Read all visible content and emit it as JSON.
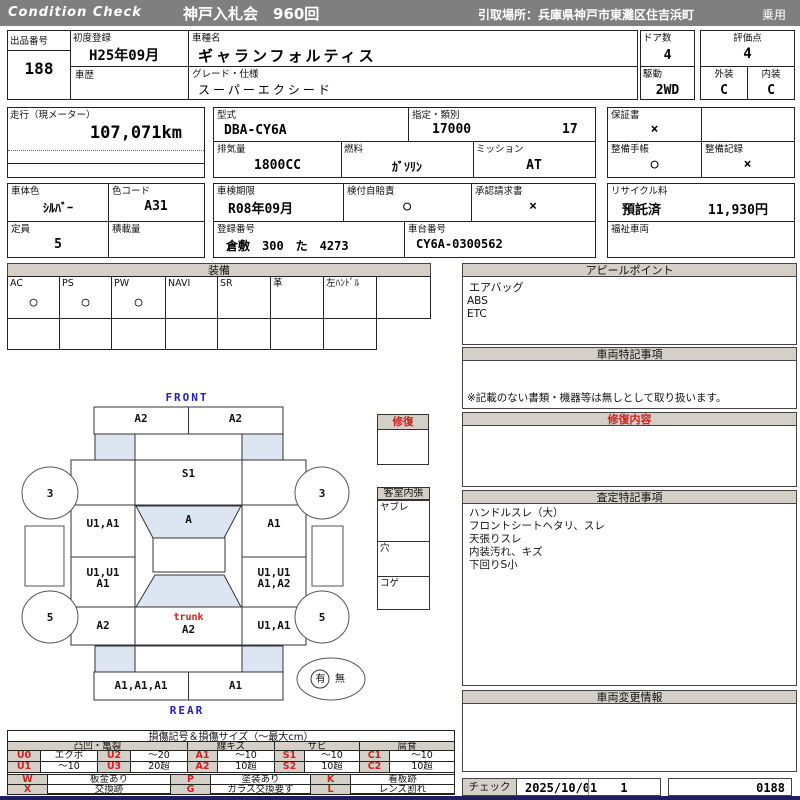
{
  "header": {
    "brand": "Condition  Check",
    "auction": "神戸入札会　960回",
    "pickup": "引取場所：兵庫県神戸市東灘区住吉浜町",
    "category": "乗用"
  },
  "info": {
    "exhibit_no_label": "出品番号",
    "exhibit_no": "188",
    "first_reg_label": "初度登録",
    "first_reg": "H25年09月",
    "history_label": "車歴",
    "model_name_label": "車種名",
    "model_name": "ギャランフォルティス",
    "grade_label": "グレード・仕様",
    "grade": "スーパーエクシード",
    "doors_label": "ドア数",
    "doors": "4",
    "drive_label": "駆動",
    "drive": "2WD",
    "score_label": "評価点",
    "score": "4",
    "exterior_label": "外装",
    "exterior": "C",
    "interior_label": "内装",
    "interior": "C",
    "mileage_label": "走行（現メーター）",
    "mileage": "107,071km",
    "model_code_label": "型式",
    "model_code": "DBA-CY6A",
    "class_label": "指定・類別",
    "class1": "17000",
    "class2": "17",
    "displacement_label": "排気量",
    "displacement": "1800CC",
    "fuel_label": "燃料",
    "fuel": "ｶﾞｿﾘﾝ",
    "mission_label": "ミッション",
    "mission": "AT",
    "warranty_label": "保証書",
    "warranty": "×",
    "maintenance_book_label": "整備手帳",
    "maintenance_book": "○",
    "maintenance_record_label": "整備記録",
    "maintenance_record": "×",
    "body_color_label": "車体色",
    "body_color": "ｼﾙﾊﾞｰ",
    "color_code_label": "色コード",
    "color_code": "A31",
    "capacity_label": "定員",
    "capacity": "5",
    "load_label": "積載量",
    "inspection_label": "車検期限",
    "inspection": "R08年09月",
    "insurance_label": "検付自賠責",
    "insurance": "○",
    "approval_label": "承認請求書",
    "approval": "×",
    "reg_no_label": "登録番号",
    "reg_no": "倉敷　300　た　4273",
    "chassis_label": "車台番号",
    "chassis": "CY6A-0300562",
    "recycle_label": "リサイクル料",
    "recycle_status": "預託済",
    "recycle_fee": "11,930円",
    "welfare_label": "福祉車両"
  },
  "equipment": {
    "title": "装備",
    "items": [
      {
        "label": "AC",
        "value": "○"
      },
      {
        "label": "PS",
        "value": "○"
      },
      {
        "label": "PW",
        "value": "○"
      },
      {
        "label": "NAVI",
        "value": ""
      },
      {
        "label": "SR",
        "value": ""
      },
      {
        "label": "革",
        "value": ""
      },
      {
        "label": "左ﾊﾝﾄﾞﾙ",
        "value": ""
      }
    ]
  },
  "panels": {
    "appeal": {
      "title": "アピールポイント",
      "lines": [
        "エアバッグ",
        "ABS",
        "ETC"
      ]
    },
    "vehicle_notes": {
      "title": "車両特記事項",
      "disclaimer": "※記載のない書類・機器等は無しとして取り扱います。"
    },
    "repair": {
      "title": "修復内容"
    },
    "assessment": {
      "title": "査定特記事項",
      "lines": [
        "ハンドルスレ（大）",
        "フロントシートヘタリ、スレ",
        "天張りスレ",
        "内装汚れ、キズ",
        "下回りS小"
      ]
    },
    "change": {
      "title": "車両変更情報"
    },
    "check": {
      "label": "チェック",
      "date": "2025/10/01",
      "count": "1",
      "number": "0188"
    }
  },
  "diagram": {
    "front_label": "FRONT",
    "rear_label": "REAR",
    "front_bumper_left": "A2",
    "front_bumper_right": "A2",
    "hood": "S1",
    "windshield": "A",
    "fender_left": "U1,A1",
    "fender_right": "A1",
    "door_left": "U1,U1\nA1",
    "door_right": "U1,U1\nA1,A2",
    "quarter_left": "A2",
    "quarter_right": "U1,A1",
    "trunk_caption": "trunk",
    "trunk_code": "A2",
    "rear_bumper_left": "A1,A1,A1",
    "rear_bumper_right": "A1",
    "wheel_front": "3",
    "wheel_rear": "5",
    "presence_yes": "有",
    "presence_no": "無",
    "repair_box_title": "修復",
    "cabin_title": "客室内張",
    "cabin_rows": [
      "ヤブレ",
      "穴",
      "コゲ"
    ]
  },
  "legend": {
    "title": "損傷記号＆損傷サイズ（〜最大cm）",
    "groups": [
      "凸凹・亀裂",
      "線キズ",
      "サビ",
      "腐食"
    ],
    "rows": [
      [
        "U0",
        "エクボ",
        "U2",
        "～20",
        "A1",
        "～10",
        "S1",
        "～10",
        "C1",
        "～10"
      ],
      [
        "U1",
        "～10",
        "U3",
        "20超",
        "A2",
        "10超",
        "S2",
        "10超",
        "C2",
        "10超"
      ]
    ],
    "rows2": [
      [
        "W",
        "板金あり",
        "P",
        "塗装あり",
        "K",
        "看板跡"
      ],
      [
        "X",
        "交換跡",
        "G",
        "ガラス交換要す",
        "L",
        "レンズ割れ"
      ]
    ]
  },
  "colors": {
    "bar_gray": "#7f7f7f",
    "panel_header": "#d4d0c8",
    "shade_blue": "#dce6f2",
    "accent_red": "#cc2222",
    "accent_blue": "#2222bb",
    "footer_navy": "#1f1f60"
  }
}
